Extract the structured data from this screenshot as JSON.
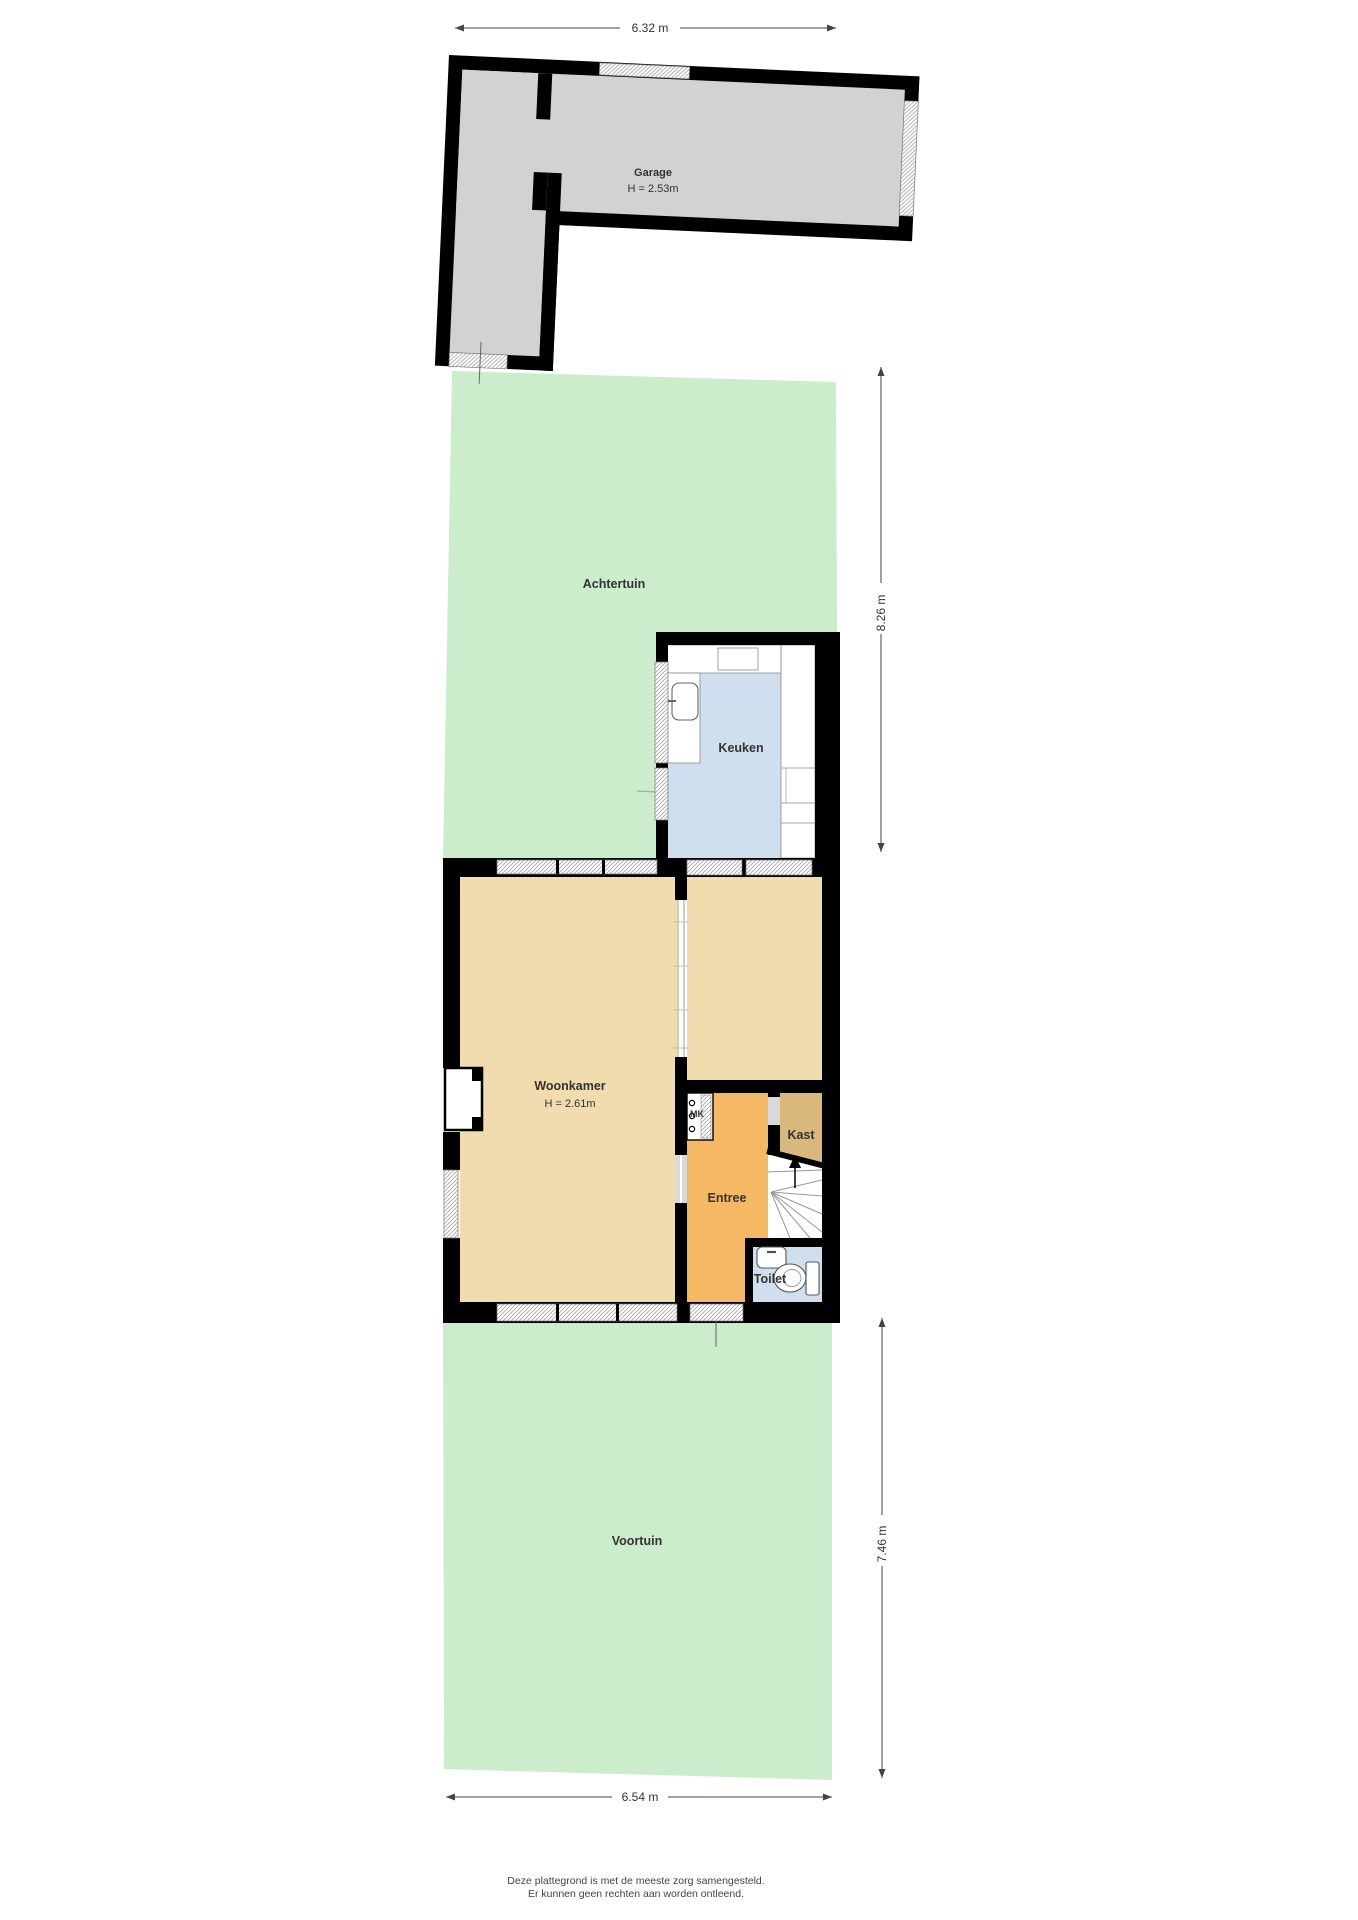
{
  "title": "Floor plan (plattegrond) begane grond met tuin",
  "rooms": {
    "garage": {
      "label": "Garage",
      "height": "H = 2.53m"
    },
    "achtertuin": {
      "label": "Achtertuin"
    },
    "keuken": {
      "label": "Keuken"
    },
    "woonkamer": {
      "label": "Woonkamer",
      "height": "H = 2.61m"
    },
    "entree": {
      "label": "Entree"
    },
    "kast": {
      "label": "Kast"
    },
    "mk": {
      "label": "MK"
    },
    "toilet": {
      "label": "Toilet"
    },
    "voortuin": {
      "label": "Voortuin"
    }
  },
  "dimensions": {
    "top": "6.32 m",
    "right_upper": "8.26 m",
    "right_lower": "7.46 m",
    "bottom": "6.54 m"
  },
  "footer": {
    "line1": "Deze plattegrond is met de meeste zorg samengesteld.",
    "line2": "Er kunnen geen rechten aan worden ontleend."
  },
  "colors": {
    "garden": "#cbedcb",
    "garage_floor": "#d2d2d2",
    "living_floor": "#f0dcae",
    "kitchen_floor": "#cfdfee",
    "hall_floor": "#f5b966",
    "closet_floor": "#d9b87c",
    "walls": "#000000"
  }
}
